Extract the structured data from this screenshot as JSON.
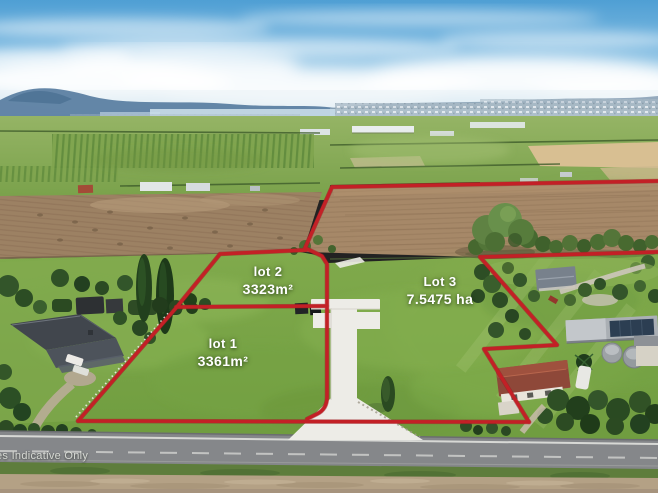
{
  "scene": {
    "type": "aerial-photograph",
    "subject": "rural lifestyle subdivision with three lots outlined in red"
  },
  "lots": [
    {
      "name": "lot 1",
      "area": "3361m²"
    },
    {
      "name": "lot 2",
      "area": "3323m²"
    },
    {
      "name": "Lot 3",
      "area": "7.5475 ha"
    }
  ],
  "watermark": "es Indicative Only",
  "colors": {
    "boundary_red": "#c32026"
  }
}
